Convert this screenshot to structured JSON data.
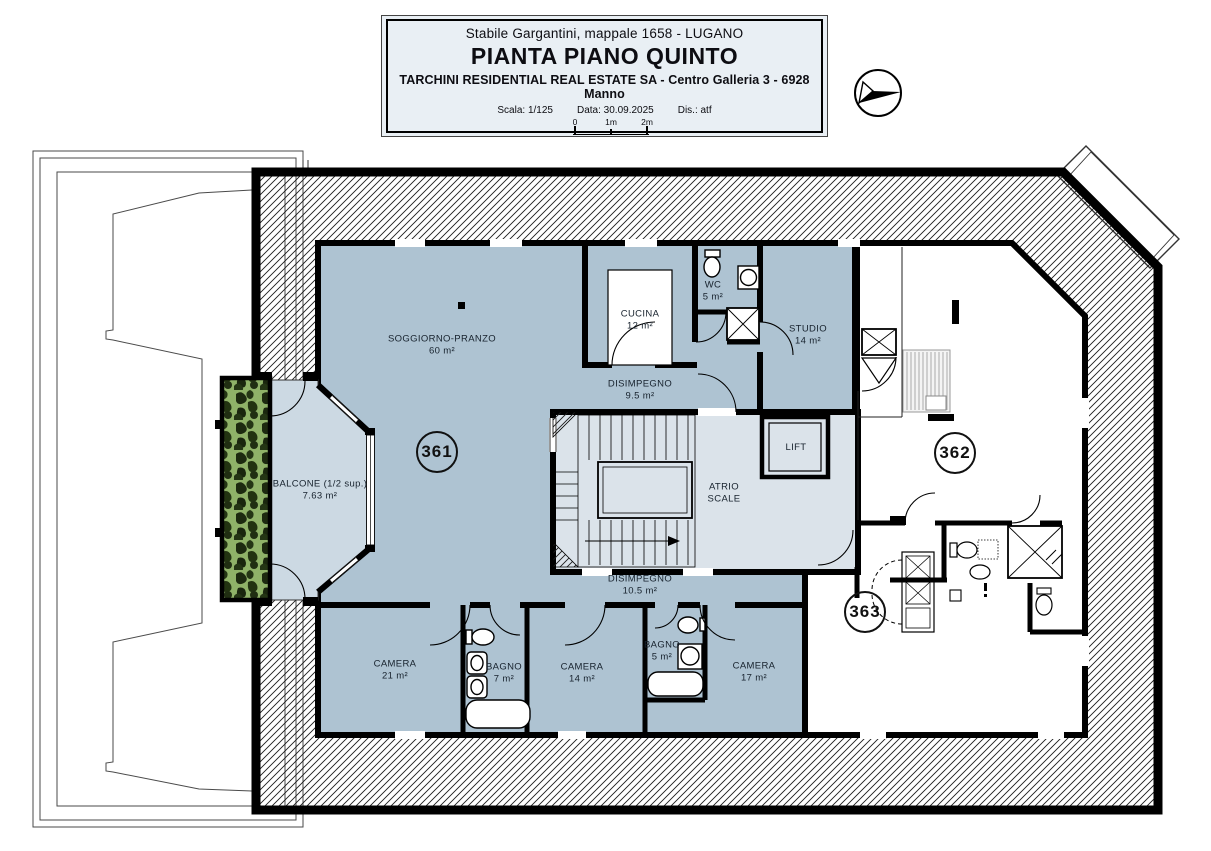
{
  "title_block": {
    "line1": "Stabile Gargantini, mappale 1658 - LUGANO",
    "title": "PIANTA PIANO QUINTO",
    "line3": "TARCHINI RESIDENTIAL REAL ESTATE SA - Centro Galleria 3 - 6928 Manno",
    "scale_label": "Scala: 1/125",
    "date_label": "Data: 30.09.2025",
    "drafter_label": "Dis.: atf",
    "scale_bar": {
      "t0": "0",
      "t1": "1m",
      "t2": "2m"
    }
  },
  "units": {
    "u361": "361",
    "u362": "362",
    "u363": "363"
  },
  "rooms": [
    {
      "id": "soggiorno",
      "line1": "SOGGIORNO-PRANZO",
      "line2": "60 m²"
    },
    {
      "id": "cucina",
      "line1": "CUCINA",
      "line2": "12 m²"
    },
    {
      "id": "wc",
      "line1": "WC",
      "line2": "5 m²"
    },
    {
      "id": "studio",
      "line1": "STUDIO",
      "line2": "14 m²"
    },
    {
      "id": "disimpegno9",
      "line1": "DISIMPEGNO",
      "line2": "9.5 m²"
    },
    {
      "id": "atrio",
      "line1": "ATRIO",
      "line2": "SCALE"
    },
    {
      "id": "lift",
      "line1": "LIFT",
      "line2": ""
    },
    {
      "id": "disimpegno10",
      "line1": "DISIMPEGNO",
      "line2": "10.5 m²"
    },
    {
      "id": "camera21",
      "line1": "CAMERA",
      "line2": "21 m²"
    },
    {
      "id": "bagno7",
      "line1": "BAGNO",
      "line2": "7 m²"
    },
    {
      "id": "camera14",
      "line1": "CAMERA",
      "line2": "14 m²"
    },
    {
      "id": "bagno5",
      "line1": "BAGNO",
      "line2": "5 m²"
    },
    {
      "id": "camera17",
      "line1": "CAMERA",
      "line2": "17 m²"
    },
    {
      "id": "balcone",
      "line1": "BALCONE (1/2 sup.)",
      "line2": "7.63 m²"
    }
  ],
  "colors": {
    "room_fill": "#aec3d2",
    "hall_fill": "#dbe3ea",
    "balcony_fill": "#ccd9e3",
    "planter_green": "#8fb268",
    "wall": "#000000",
    "title_bg": "#e9eff4"
  }
}
